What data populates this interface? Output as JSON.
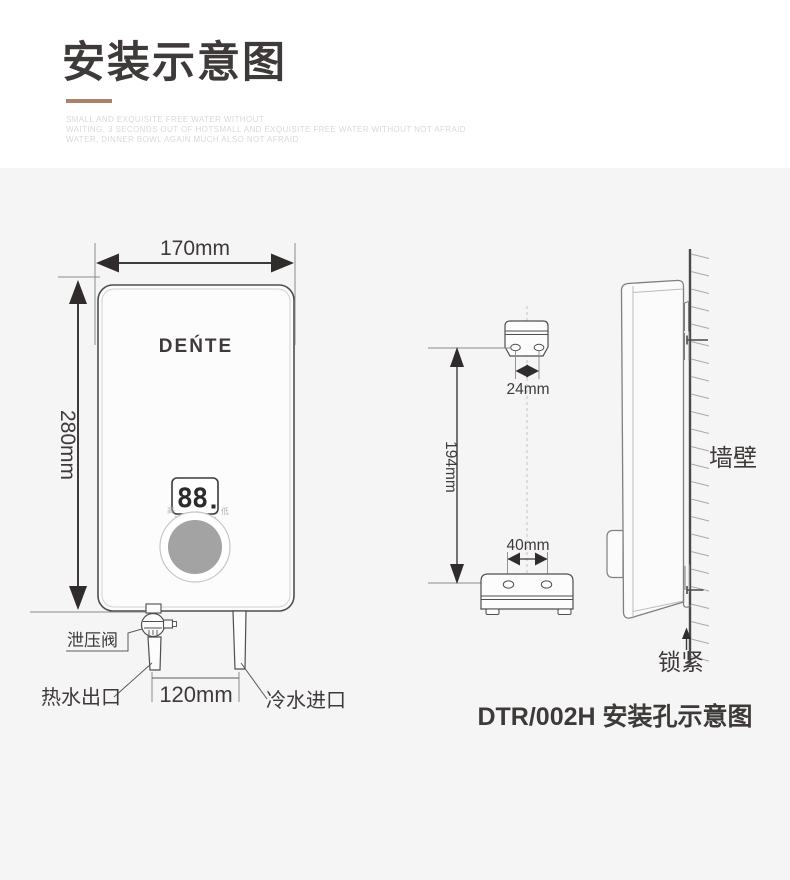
{
  "header": {
    "title": "安装示意图",
    "subtitle_lines": [
      "SMALL AND EXQUISITE FREE WATER WITHOUT",
      "WAITING, 3 SECONDS OUT OF HOTSMALL AND EXQUISITE FREE WATER WITHOUT NOT AFRAID",
      "WATER, DINNER BOWL AGAIN MUCH ALSO NOT AFRAID"
    ]
  },
  "front_view": {
    "brand": "DEŃTE",
    "display_value": "88",
    "knob_high_label": "高",
    "knob_low_label": "低",
    "width_dim": "170mm",
    "height_dim": "280mm",
    "pipe_distance_dim": "120mm",
    "relief_valve_label": "泄压阀",
    "hot_water_label": "热水出口",
    "cold_water_label": "冷水进口"
  },
  "mounting_view": {
    "top_holes_dim": "24mm",
    "vertical_dim": "194mm",
    "bottom_holes_dim": "40mm"
  },
  "side_view": {
    "wall_label": "墙壁",
    "lock_label": "锁紧"
  },
  "caption": "DTR/002H 安装孔示意图",
  "colors": {
    "accent": "#ab8168",
    "title": "#3e3a39",
    "subtitle": "#d9d9d9",
    "line_dark": "#4f4d50",
    "line_gray": "#8a8a8a",
    "panel_bg": "#f5f5f5",
    "knob_fill": "#a3a3a3"
  }
}
